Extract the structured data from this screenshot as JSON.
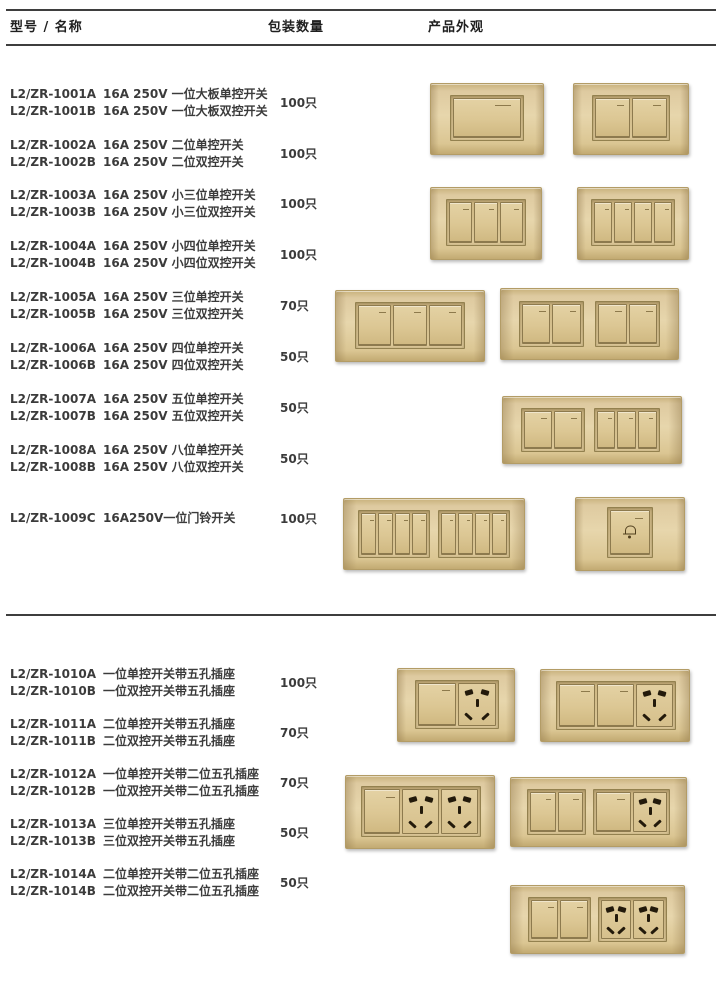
{
  "header": {
    "col_model": "型号 / 名称",
    "col_qty": "包装数量",
    "col_look": "产品外观"
  },
  "colors": {
    "plate_gold": "#e0cc9c",
    "plate_gold_dark": "#b39c66",
    "line": "#3e3e3e",
    "text": "#3b3b3b",
    "socket_hole": "#231a0b"
  },
  "products": [
    {
      "model_a": "L2/ZR-1001A",
      "desc_a": "16A 250V 一位大板单控开关",
      "model_b": "L2/ZR-1001B",
      "desc_b": "16A 250V 一位大板双控开关",
      "qty": "100只"
    },
    {
      "model_a": "L2/ZR-1002A",
      "desc_a": "16A 250V 二位单控开关",
      "model_b": "L2/ZR-1002B",
      "desc_b": "16A 250V 二位双控开关",
      "qty": "100只"
    },
    {
      "model_a": "L2/ZR-1003A",
      "desc_a": "16A 250V 小三位单控开关",
      "model_b": "L2/ZR-1003B",
      "desc_b": "16A 250V 小三位双控开关",
      "qty": "100只"
    },
    {
      "model_a": "L2/ZR-1004A",
      "desc_a": "16A 250V 小四位单控开关",
      "model_b": "L2/ZR-1004B",
      "desc_b": "16A 250V 小四位双控开关",
      "qty": "100只"
    },
    {
      "model_a": "L2/ZR-1005A",
      "desc_a": "16A 250V 三位单控开关",
      "model_b": "L2/ZR-1005B",
      "desc_b": "16A 250V 三位双控开关",
      "qty": "70只"
    },
    {
      "model_a": "L2/ZR-1006A",
      "desc_a": "16A 250V 四位单控开关",
      "model_b": "L2/ZR-1006B",
      "desc_b": "16A 250V 四位双控开关",
      "qty": "50只"
    },
    {
      "model_a": "L2/ZR-1007A",
      "desc_a": "16A 250V 五位单控开关",
      "model_b": "L2/ZR-1007B",
      "desc_b": "16A 250V 五位双控开关",
      "qty": "50只"
    },
    {
      "model_a": "L2/ZR-1008A",
      "desc_a": "16A 250V 八位单控开关",
      "model_b": "L2/ZR-1008B",
      "desc_b": "16A 250V 八位双控开关",
      "qty": "50只"
    },
    {
      "model_a": "L2/ZR-1009C",
      "desc_a": "16A250V一位门铃开关",
      "qty": "100只"
    },
    {
      "model_a": "L2/ZR-1010A",
      "desc_a": "一位单控开关带五孔插座",
      "model_b": "L2/ZR-1010B",
      "desc_b": "一位双控开关带五孔插座",
      "qty": "100只"
    },
    {
      "model_a": "L2/ZR-1011A",
      "desc_a": "二位单控开关带五孔插座",
      "model_b": "L2/ZR-1011B",
      "desc_b": "二位双控开关带五孔插座",
      "qty": "70只"
    },
    {
      "model_a": "L2/ZR-1012A",
      "desc_a": "一位单控开关带二位五孔插座",
      "model_b": "L2/ZR-1012B",
      "desc_b": "一位双控开关带二位五孔插座",
      "qty": "70只"
    },
    {
      "model_a": "L2/ZR-1013A",
      "desc_a": "三位单控开关带五孔插座",
      "model_b": "L2/ZR-1013B",
      "desc_b": "三位双控开关带五孔插座",
      "qty": "50只"
    },
    {
      "model_a": "L2/ZR-1014A",
      "desc_a": "二位单控开关带二位五孔插座",
      "model_b": "L2/ZR-1014B",
      "desc_b": "二位双控开关带二位五孔插座",
      "qty": "50只"
    }
  ]
}
